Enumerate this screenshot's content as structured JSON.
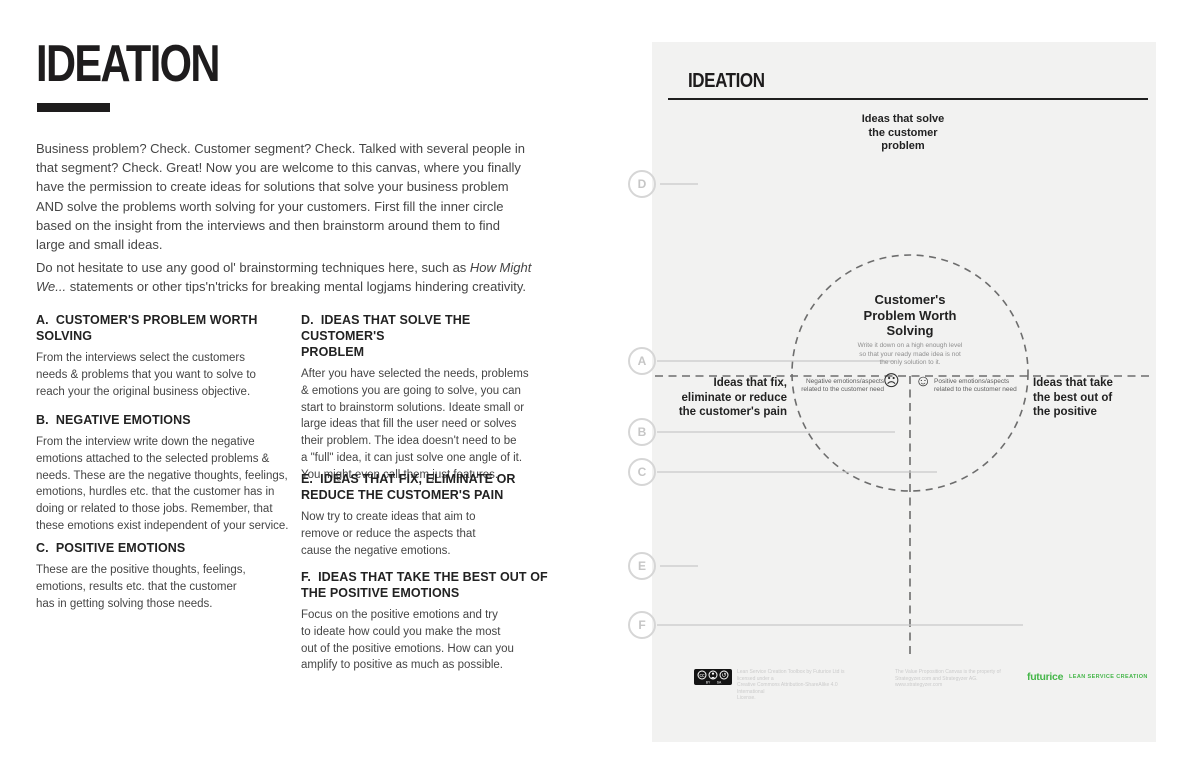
{
  "colors": {
    "accent_green": "#45b649",
    "canvas_bg": "#f2f2f1",
    "ink": "#1e1c1d",
    "muted_gray": "#c6c6c6"
  },
  "page": {
    "title": "IDEATION",
    "intro_p1": "Business problem? Check. Customer segment? Check. Talked with several people in\nthat segment? Check. Great! Now you are welcome to this canvas, where you finally\nhave the permission to create ideas for solutions that solve your business problem\nAND solve the problems worth solving for your customers. First fill the inner circle\nbased on the insight from the interviews and then brainstorm around them to find\nlarge and small ideas.",
    "intro_p2": {
      "l1_text": "Do not hesitate to use any good ol' brainstorming techniques here, such as ",
      "l1_italic": "How Might",
      "l2_italic": "We...",
      "l2_text": " statements or other tips'n'tricks for breaking mental logjams hindering creativity."
    }
  },
  "sections": [
    {
      "id": "A",
      "heading": "A.  CUSTOMER'S PROBLEM WORTH\nSOLVING",
      "body": "From the interviews select the customers\nneeds & problems that you want to solve to\nreach your the original business objective."
    },
    {
      "id": "B",
      "heading": "B.  NEGATIVE EMOTIONS",
      "body": "From the interview write down the negative\nemotions attached to the selected problems &\nneeds. These are the negative thoughts, feelings,\nemotions, hurdles etc. that the customer has in\ndoing or related to those jobs. Remember, that\nthese emotions exist independent of your service."
    },
    {
      "id": "C",
      "heading": "C.  POSITIVE EMOTIONS",
      "body": "These are the positive thoughts, feelings,\nemotions, results etc. that the customer\nhas in getting solving those needs."
    },
    {
      "id": "D",
      "heading": "D.  IDEAS THAT SOLVE THE CUSTOMER'S\nPROBLEM",
      "body": "After you have selected the needs, problems\n& emotions you are going to solve,  you can\nstart to brainstorm solutions. Ideate small or\nlarge ideas that fill the user need or solves\ntheir problem. The idea doesn't need to be\na \"full\" idea, it can just solve one angle of it.\nYou might even call them just features."
    },
    {
      "id": "E",
      "heading": "E.  IDEAS THAT FIX, ELIMINATE OR\nREDUCE THE CUSTOMER'S PAIN",
      "body": "Now try to create ideas that aim to\nremove or reduce the aspects that\ncause the negative emotions."
    },
    {
      "id": "F",
      "heading": "F.  IDEAS THAT TAKE THE BEST OUT OF\nTHE POSITIVE EMOTIONS",
      "body": "Focus on the positive emotions and try\nto ideate how could you make the most\nout of the positive emotions. How can you\namplify to positive as much as possible."
    }
  ],
  "canvas": {
    "title": "IDEATION",
    "top_label": "Ideas that solve\nthe customer\nproblem",
    "center_title": "Customer's\nProblem Worth\nSolving",
    "center_sub": "Write it down on a high enough level\nso that your ready made idea is not\nthe only solution to it.",
    "left_label": "Ideas that fix,\neliminate or reduce\nthe customer's pain",
    "right_label": "Ideas that take\nthe best out of\nthe positive",
    "negative_label": "Negative emotions/aspects\nrelated to the customer need",
    "positive_label": "Positive emotions/aspects\nrelated to the customer need",
    "sad_face": "☹",
    "happy_face": "☺",
    "markers": [
      "D",
      "A",
      "B",
      "C",
      "E",
      "F"
    ],
    "footer": {
      "license": "Lean Service Creation Toolbox by Futurice Ltd is licensed under a\nCreative Commons Attribution-ShareAlike 4.0 International\nLicense.",
      "strategyzer": "The Value Proposition Canvas is the property of\nStrategyzer.com and Strategyzer AG.\nwww.strategyzer.com",
      "logo": "futurice",
      "lsc": "LEAN SERVICE CREATION"
    }
  }
}
